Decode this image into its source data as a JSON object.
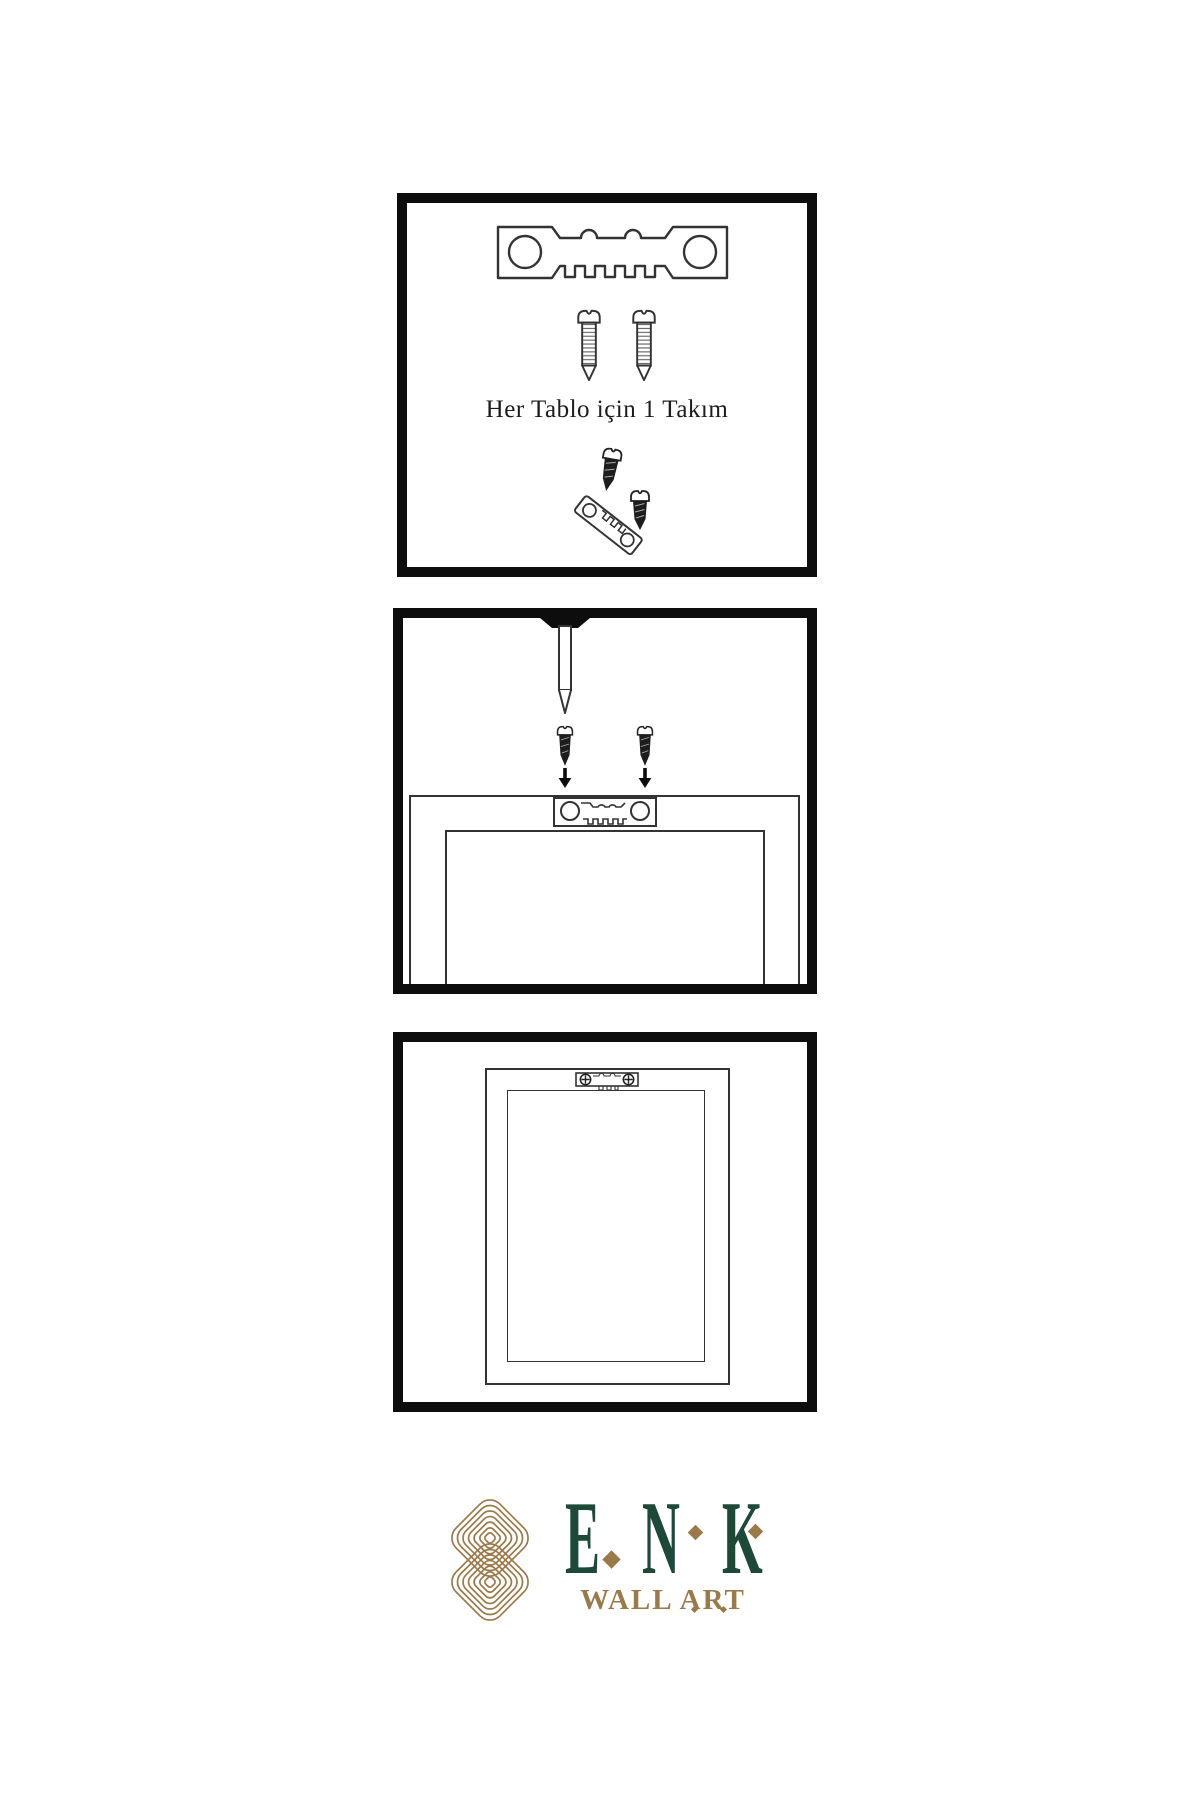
{
  "brand": {
    "green": "#1d4938",
    "gold": "#9b7a49",
    "ink": "#0d0d0d",
    "line": "#333333",
    "paper": "#ffffff"
  },
  "panels": {
    "step1": {
      "name": "hardware-kit",
      "caption": "Her Tablo için 1 Takım",
      "icons": [
        "sawtooth-hanger-icon",
        "screw-icon",
        "screw-icon",
        "small-screw-icon",
        "angled-sawtooth-hanger-icon",
        "small-screw-icon"
      ]
    },
    "step2": {
      "name": "attach-hanger-to-frame",
      "icons": [
        "nail-icon",
        "small-screw-icon",
        "small-screw-icon",
        "arrow-down-icon",
        "arrow-down-icon",
        "sawtooth-plate-icon",
        "frame-back-icon"
      ]
    },
    "step3": {
      "name": "frame-back-mounted",
      "icons": [
        "mounted-sawtooth-plate-icon",
        "frame-back-icon"
      ]
    }
  },
  "logo": {
    "name": "ENK",
    "subtitle": "WALL ART",
    "mark": "knot-logo-icon"
  }
}
